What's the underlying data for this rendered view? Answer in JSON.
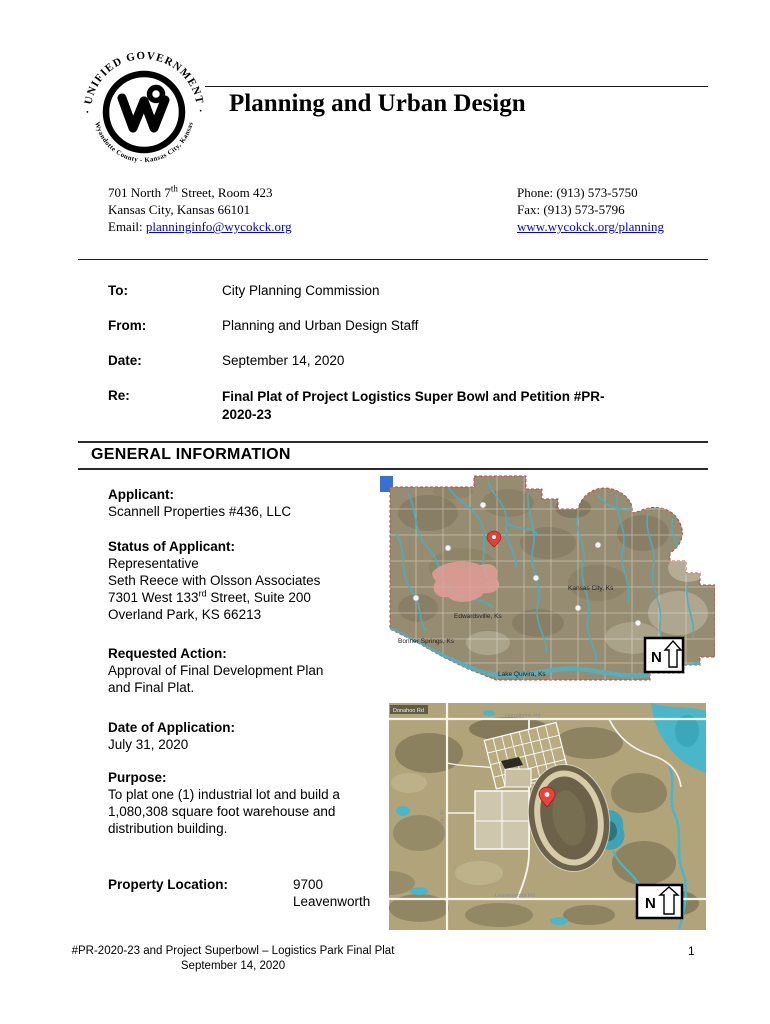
{
  "seal": {
    "top_text": "· UNIFIED GOVERNMENT ·",
    "bottom_text": "Wyandotte County - Kansas City, Kansas"
  },
  "header": {
    "title": "Planning and Urban Design"
  },
  "contact": {
    "address": {
      "line1_pre": "701 North 7",
      "line1_sup": "th",
      "line1_post": " Street, Room 423",
      "line2": "Kansas City, Kansas 66101",
      "email_label": "Email: ",
      "email_link": "planninginfo@wycokck.org"
    },
    "phone": "Phone: (913) 573-5750",
    "fax": "Fax: (913) 573-5796",
    "website": "www.wycokck.org/planning"
  },
  "memo": {
    "to_label": "To:",
    "to_value": "City Planning Commission",
    "from_label": "From:",
    "from_value": "Planning and Urban Design Staff",
    "date_label": "Date:",
    "date_value": "September 14, 2020",
    "re_label": "Re:",
    "re_value": "Final Plat of Project Logistics Super Bowl and Petition #PR-\n2020-23"
  },
  "general_info": {
    "section_title": "GENERAL INFORMATION",
    "applicant": {
      "label": "Applicant:",
      "value": "Scannell Properties #436, LLC"
    },
    "status_of_applicant": {
      "label": "Status of Applicant:",
      "line1": "Representative",
      "line2": "Seth Reece with Olsson Associates",
      "line3_pre": "7301 West 133",
      "line3_sup": "rd",
      "line3_post": " Street, Suite 200",
      "line4": "Overland Park, KS 66213"
    },
    "requested_action": {
      "label": "Requested Action:",
      "value": "Approval of Final Development Plan\nand Final Plat."
    },
    "date_of_application": {
      "label": "Date of Application:",
      "value": "July 31, 2020"
    },
    "purpose": {
      "label": "Purpose:",
      "value": "To plat one (1) industrial lot and build a\n1,080,308 square foot warehouse and\ndistribution building."
    },
    "property_location": {
      "label": "Property Location:",
      "value": "9700\nLeavenworth"
    }
  },
  "maps": {
    "county": {
      "label_edwardsville": "Edwardsville, Ks",
      "label_bonner": "Bonner Springs, Ks",
      "label_kck": "Kansas City, Ks",
      "label_quivira": "Lake Quivira, Ks",
      "north": "N"
    },
    "site": {
      "label_top_left": "Donahoo Rd",
      "label_top_road": "Hurrelbrink Rd",
      "label_bottom_road": "Leavenworth Rd",
      "label_left_road": "N 99th St",
      "north": "N"
    }
  },
  "footer": {
    "line1": "#PR-2020-23 and Project Superbowl – Logistics Park Final Plat",
    "line2": "September 14, 2020",
    "page_number": "1"
  },
  "colors": {
    "link_blue": "#0000ee",
    "water_teal": "#4aafc0",
    "pin_red": "#e0403a",
    "highlight_pink": "#e89f9b",
    "marker_blue": "#3b6fd4"
  }
}
